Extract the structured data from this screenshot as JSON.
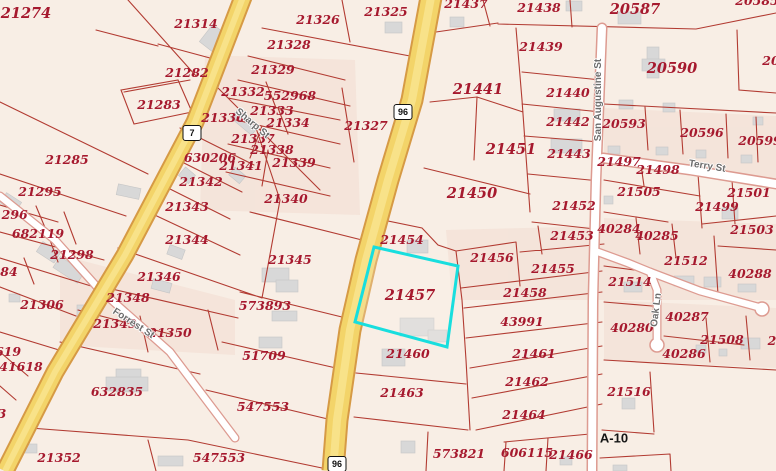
{
  "map": {
    "type": "parcel-map",
    "highlighted_parcel": "21457",
    "colors": {
      "background": "#f8eee5",
      "parcel_line": "#b23b32",
      "parcel_label": "#a6192e",
      "highlight": "#18dede",
      "highway_fill": "#f3d469",
      "highway_casing": "#d69a45",
      "street_fill": "#ffffff",
      "street_casing": "#dd9b91",
      "building": "#d8d8d8"
    },
    "highway_shields": [
      {
        "route": "96",
        "x": 403,
        "y": 112
      },
      {
        "route": "96",
        "x": 337,
        "y": 464
      },
      {
        "route": "7",
        "x": 192,
        "y": 133
      }
    ],
    "street_labels": [
      {
        "name": "San Augustine St",
        "x": 599,
        "y": 100,
        "rot": -90
      },
      {
        "name": "Terry St",
        "x": 707,
        "y": 167,
        "rot": 9
      },
      {
        "name": "Oak Ln",
        "x": 657,
        "y": 310,
        "rot": -83
      },
      {
        "name": "Sharp St",
        "x": 252,
        "y": 124,
        "rot": 40
      },
      {
        "name": "Forrest St",
        "x": 133,
        "y": 324,
        "rot": 33
      }
    ],
    "survey_label": {
      "text": "A-10",
      "x": 614,
      "y": 438
    },
    "parcel_labels": [
      {
        "t": "21274",
        "x": 26,
        "y": 14,
        "big": true
      },
      {
        "t": "21314",
        "x": 196,
        "y": 24
      },
      {
        "t": "21326",
        "x": 318,
        "y": 20
      },
      {
        "t": "21325",
        "x": 386,
        "y": 12
      },
      {
        "t": "21437",
        "x": 466,
        "y": 4
      },
      {
        "t": "21438",
        "x": 539,
        "y": 8
      },
      {
        "t": "20587",
        "x": 635,
        "y": 10,
        "big": true
      },
      {
        "t": "20585",
        "x": 757,
        "y": 1
      },
      {
        "t": "21282",
        "x": 187,
        "y": 73
      },
      {
        "t": "21283",
        "x": 159,
        "y": 105
      },
      {
        "t": "21328",
        "x": 289,
        "y": 45
      },
      {
        "t": "21329",
        "x": 273,
        "y": 70
      },
      {
        "t": "21332",
        "x": 243,
        "y": 92
      },
      {
        "t": "552968",
        "x": 290,
        "y": 96
      },
      {
        "t": "21333",
        "x": 272,
        "y": 111
      },
      {
        "t": "21336",
        "x": 223,
        "y": 118
      },
      {
        "t": "21334",
        "x": 288,
        "y": 123
      },
      {
        "t": "21327",
        "x": 366,
        "y": 126
      },
      {
        "t": "21337",
        "x": 253,
        "y": 139
      },
      {
        "t": "21338",
        "x": 272,
        "y": 150
      },
      {
        "t": "21341",
        "x": 241,
        "y": 166
      },
      {
        "t": "21339",
        "x": 294,
        "y": 163
      },
      {
        "t": "21340",
        "x": 286,
        "y": 199
      },
      {
        "t": "21439",
        "x": 541,
        "y": 47
      },
      {
        "t": "20590",
        "x": 672,
        "y": 69,
        "big": true
      },
      {
        "t": "20",
        "x": 771,
        "y": 61
      },
      {
        "t": "21440",
        "x": 568,
        "y": 93
      },
      {
        "t": "21441",
        "x": 478,
        "y": 90,
        "big": true
      },
      {
        "t": "21442",
        "x": 568,
        "y": 122
      },
      {
        "t": "20593",
        "x": 624,
        "y": 124
      },
      {
        "t": "20596",
        "x": 702,
        "y": 133
      },
      {
        "t": "20599",
        "x": 760,
        "y": 141
      },
      {
        "t": "21443",
        "x": 569,
        "y": 154
      },
      {
        "t": "21497",
        "x": 619,
        "y": 162
      },
      {
        "t": "21498",
        "x": 658,
        "y": 170
      },
      {
        "t": "21451",
        "x": 511,
        "y": 150,
        "big": true
      },
      {
        "t": "21450",
        "x": 472,
        "y": 194,
        "big": true
      },
      {
        "t": "21505",
        "x": 639,
        "y": 192
      },
      {
        "t": "21501",
        "x": 749,
        "y": 193
      },
      {
        "t": "21499",
        "x": 717,
        "y": 207
      },
      {
        "t": "21452",
        "x": 574,
        "y": 206
      },
      {
        "t": "21503",
        "x": 752,
        "y": 230
      },
      {
        "t": "40284",
        "x": 619,
        "y": 229
      },
      {
        "t": "40285",
        "x": 657,
        "y": 236
      },
      {
        "t": "21512",
        "x": 686,
        "y": 261
      },
      {
        "t": "40288",
        "x": 750,
        "y": 274
      },
      {
        "t": "21514",
        "x": 630,
        "y": 282
      },
      {
        "t": "40280",
        "x": 632,
        "y": 328
      },
      {
        "t": "40287",
        "x": 687,
        "y": 317
      },
      {
        "t": "21508",
        "x": 722,
        "y": 340
      },
      {
        "t": "2",
        "x": 772,
        "y": 341
      },
      {
        "t": "40286",
        "x": 684,
        "y": 354
      },
      {
        "t": "21516",
        "x": 629,
        "y": 392
      },
      {
        "t": "21453",
        "x": 572,
        "y": 236
      },
      {
        "t": "21456",
        "x": 492,
        "y": 258
      },
      {
        "t": "21455",
        "x": 553,
        "y": 269
      },
      {
        "t": "21458",
        "x": 525,
        "y": 293
      },
      {
        "t": "43991",
        "x": 522,
        "y": 322
      },
      {
        "t": "21461",
        "x": 534,
        "y": 354
      },
      {
        "t": "21462",
        "x": 527,
        "y": 382
      },
      {
        "t": "21464",
        "x": 524,
        "y": 415
      },
      {
        "t": "606115",
        "x": 527,
        "y": 453
      },
      {
        "t": "21466",
        "x": 571,
        "y": 455
      },
      {
        "t": "573821",
        "x": 459,
        "y": 454
      },
      {
        "t": "21454",
        "x": 402,
        "y": 240
      },
      {
        "t": "21457",
        "x": 410,
        "y": 296,
        "big": true
      },
      {
        "t": "21460",
        "x": 408,
        "y": 354
      },
      {
        "t": "21463",
        "x": 402,
        "y": 393
      },
      {
        "t": "21285",
        "x": 67,
        "y": 160
      },
      {
        "t": "21295",
        "x": 40,
        "y": 192
      },
      {
        "t": "21296",
        "x": 6,
        "y": 215
      },
      {
        "t": "682119",
        "x": 38,
        "y": 234
      },
      {
        "t": "630206",
        "x": 210,
        "y": 158
      },
      {
        "t": "21342",
        "x": 201,
        "y": 182
      },
      {
        "t": "21343",
        "x": 187,
        "y": 207
      },
      {
        "t": "21344",
        "x": 187,
        "y": 240
      },
      {
        "t": "21345",
        "x": 290,
        "y": 260
      },
      {
        "t": "21298",
        "x": 72,
        "y": 255
      },
      {
        "t": "84",
        "x": 9,
        "y": 272
      },
      {
        "t": "21306",
        "x": 42,
        "y": 305
      },
      {
        "t": "21346",
        "x": 159,
        "y": 277
      },
      {
        "t": "21348",
        "x": 128,
        "y": 298
      },
      {
        "t": "21349",
        "x": 115,
        "y": 324
      },
      {
        "t": "21350",
        "x": 170,
        "y": 333
      },
      {
        "t": "573893",
        "x": 265,
        "y": 306
      },
      {
        "t": "51709",
        "x": 264,
        "y": 356
      },
      {
        "t": "547553",
        "x": 263,
        "y": 407
      },
      {
        "t": "547553",
        "x": 219,
        "y": 458
      },
      {
        "t": "632835",
        "x": 117,
        "y": 392
      },
      {
        "t": "21352",
        "x": 59,
        "y": 458
      },
      {
        "t": "619",
        "x": 8,
        "y": 352
      },
      {
        "t": "41618",
        "x": 21,
        "y": 367
      },
      {
        "t": "3",
        "x": 2,
        "y": 414
      }
    ]
  }
}
